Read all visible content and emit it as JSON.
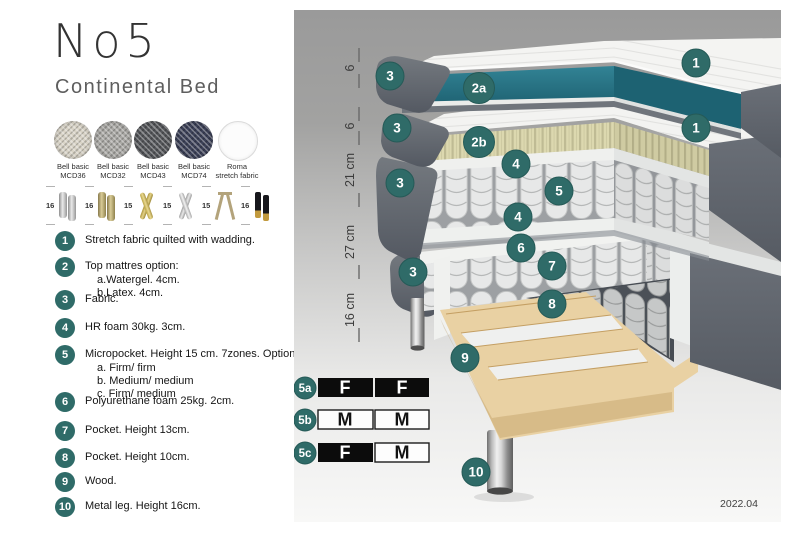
{
  "header": {
    "title": "No5",
    "subtitle": "Continental Bed"
  },
  "fabrics": [
    {
      "line1": "Bell basic",
      "line2": "MCD36",
      "color": "#d8d3c6"
    },
    {
      "line1": "Bell basic",
      "line2": "MCD32",
      "color": "#a9a8a4"
    },
    {
      "line1": "Bell basic",
      "line2": "MCD43",
      "color": "#54565a"
    },
    {
      "line1": "Bell basic",
      "line2": "MCD74",
      "color": "#3c4158"
    },
    {
      "line1": "Roma",
      "line2": "stretch fabric",
      "color": "#fcfcfc"
    }
  ],
  "leg_options": [
    {
      "height": "16",
      "style": "chrome-cylinder"
    },
    {
      "height": "16",
      "style": "brass-cylinder"
    },
    {
      "height": "15",
      "style": "gold-cross"
    },
    {
      "height": "15",
      "style": "silver-cross"
    },
    {
      "height": "15",
      "style": "hairpin"
    },
    {
      "height": "16",
      "style": "black-gold"
    }
  ],
  "legend": {
    "items": [
      {
        "num": "1",
        "text": "Stretch fabric quilted with wadding."
      },
      {
        "num": "2",
        "text": "Top mattres option:",
        "sub": [
          "a.Watergel. 4cm.",
          "b.Latex. 4cm."
        ]
      },
      {
        "num": "3",
        "text": "Fabric."
      },
      {
        "num": "4",
        "text": "HR foam 30kg. 3cm."
      },
      {
        "num": "5",
        "text": "Micropocket. Height 15 cm. 7zones. Option:",
        "sub": [
          "a. Firm/ firm",
          "b. Medium/ medium",
          "c. Firm/ medium"
        ]
      },
      {
        "num": "6",
        "text": "Polyurethane foam 25kg. 2cm."
      },
      {
        "num": "7",
        "text": "Pocket. Height 13cm."
      },
      {
        "num": "8",
        "text": "Pocket. Height 10cm."
      },
      {
        "num": "9",
        "text": "Wood."
      },
      {
        "num": "10",
        "text": "Metal leg. Height 16cm."
      }
    ]
  },
  "diagram": {
    "scale_labels": [
      "6",
      "6",
      "21 cm",
      "27 cm",
      "16 cm"
    ],
    "badges": {
      "n1": "1",
      "n2a": "2a",
      "n2b": "2b",
      "n3": "3",
      "n4": "4",
      "n5": "5",
      "n6": "6",
      "n7": "7",
      "n8": "8",
      "n9": "9",
      "n10": "10"
    },
    "options_table": {
      "rows": [
        {
          "label": "5a",
          "cells": [
            {
              "text": "F",
              "variant": "filled"
            },
            {
              "text": "F",
              "variant": "filled"
            }
          ]
        },
        {
          "label": "5b",
          "cells": [
            {
              "text": "M",
              "variant": "outline"
            },
            {
              "text": "M",
              "variant": "outline"
            }
          ]
        },
        {
          "label": "5c",
          "cells": [
            {
              "text": "F",
              "variant": "filled"
            },
            {
              "text": "M",
              "variant": "outline"
            }
          ]
        }
      ]
    },
    "revision": "2022.04"
  },
  "colors": {
    "badge": "#2f6b68",
    "teal_core": "#2a7a8a",
    "latex": "#dbd7ae",
    "fabric_gray": "#60656d",
    "wood": "#e9d1a3"
  }
}
